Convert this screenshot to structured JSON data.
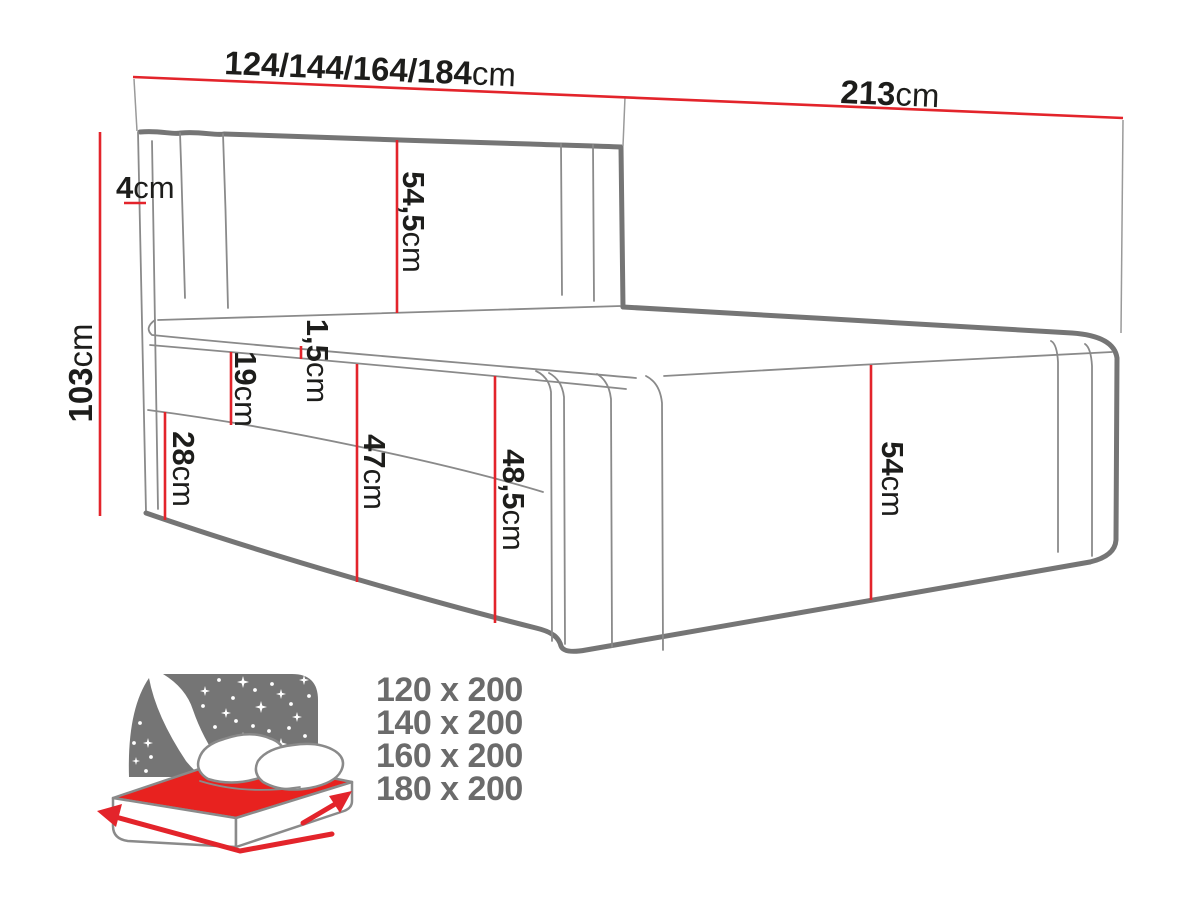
{
  "diagram": {
    "title": "bed-dimension-diagram",
    "unit_default": "cm",
    "dimensions": {
      "width_variants": {
        "value": "124/144/164/184",
        "unit": "cm"
      },
      "length": {
        "value": "213",
        "unit": "cm"
      },
      "total_height": {
        "value": "103",
        "unit": "cm"
      },
      "headboard_thickness": {
        "value": "4",
        "unit": "cm"
      },
      "headboard_above_mattress": {
        "value": "54,5",
        "unit": "cm"
      },
      "mattress_piping": {
        "value": "1,5",
        "unit": "cm"
      },
      "mattress_height": {
        "value": "19",
        "unit": "cm"
      },
      "box_height": {
        "value": "28",
        "unit": "cm"
      },
      "under_piping_height": {
        "value": "47",
        "unit": "cm"
      },
      "side_total_height": {
        "value": "48,5",
        "unit": "cm"
      },
      "foot_end_height": {
        "value": "54",
        "unit": "cm"
      }
    },
    "colors": {
      "dimension_red": "#e3242b",
      "outline_gray": "#757575",
      "seam_gray": "#8a8a8a",
      "label_black": "#1d1d1b",
      "sizes_gray": "#6b6b6b",
      "icon_sky_gray": "#757575",
      "icon_mattress_red": "#e8221f"
    },
    "icons": [
      "night-sky-bed-icon",
      "width-arrow-icon",
      "length-arrow-icon"
    ]
  },
  "size_options": {
    "items": [
      "120 x 200",
      "140 x 200",
      "160 x 200",
      "180 x 200"
    ]
  }
}
